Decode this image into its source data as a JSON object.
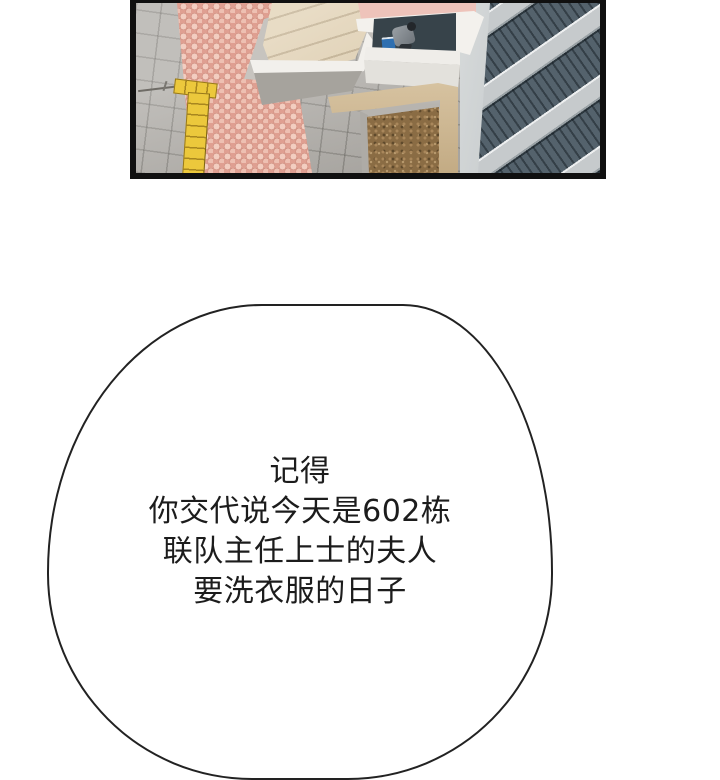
{
  "page": {
    "background": "#ffffff",
    "type": "webtoon-comic-strip"
  },
  "panel": {
    "description": "aerial isometric view of apartment courtyard",
    "elements": {
      "ground": "gray paving tiles",
      "path": "pink pebble walkway",
      "tactile": "yellow tactile paving T-strip",
      "stairs": "beige entrance steps",
      "roof": "pink rooftop edge",
      "alcove": "recessed ledge with sitting person and blue laundry basin",
      "flowerbed": "brown dirt bed with concrete curb",
      "building": "high-rise facade with balcony railings"
    },
    "palette": {
      "panel-border": "#101010",
      "tile": "#b0ada8",
      "path": "#df9f91",
      "pebble": "#f3cdc0",
      "tactile": "#ecc83c",
      "stairs": "#dcc9a6",
      "roof": "#e5aba2",
      "alcove": "#37434a",
      "dirt": "#8a6c44",
      "sand": "#d7c3a1",
      "facade-dark": "#54626c",
      "facade-beam": "#c6cacc",
      "basin": "#2e6fb0",
      "ink": "#1c1c1c",
      "paper": "#ffffff"
    }
  },
  "speech_bubble": {
    "lines": [
      "记得",
      "你交代说今天是602栋",
      "联队主任上士的夫人",
      "要洗衣服的日子"
    ]
  }
}
